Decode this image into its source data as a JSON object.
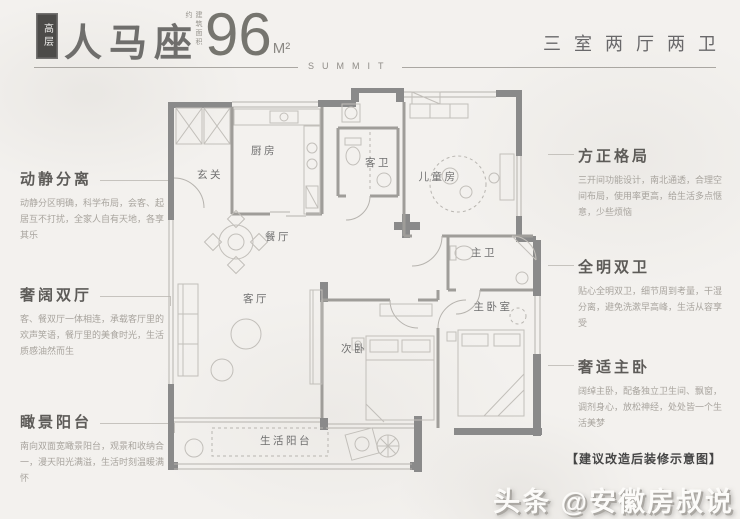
{
  "header": {
    "badge": "高层",
    "title": "人马座",
    "area_prefix": "建筑面积约",
    "area_value": "96",
    "area_unit": "M²",
    "spec": "三室两厅两卫",
    "series": "SUMMIT"
  },
  "features_left": [
    {
      "title": "动静分离",
      "desc": "动静分区明确，科学布局，会客、起居互不打扰，全家人自有天地，各享其乐"
    },
    {
      "title": "奢阔双厅",
      "desc": "客、餐双厅一体相连，承载客厅里的欢声笑语，餐厅里的美食时光，生活质感油然而生"
    },
    {
      "title": "瞰景阳台",
      "desc": "南向双面宽瞰景阳台，观景和收纳合一，漫天阳光满溢，生活时刻温暖满怀"
    }
  ],
  "features_right": [
    {
      "title": "方正格局",
      "desc": "三开间功能设计，南北通透，合理空间布局，使用率更高，给生活多点惬意，少些烦恼"
    },
    {
      "title": "全明双卫",
      "desc": "贴心全明双卫，细节周到考量，干湿分离，避免洗漱早高峰，生活从容享受"
    },
    {
      "title": "奢适主卧",
      "desc": "阔绰主卧，配备独立卫生间、飘窗，调剂身心，放松神经，处处皆一个生活美梦"
    }
  ],
  "floorplan": {
    "rooms": {
      "entry": "玄关",
      "kitchen": "厨房",
      "guest_bath": "客卫",
      "kids_room": "儿童房",
      "dining": "餐厅",
      "living": "客厅",
      "second_bedroom": "次卧",
      "master_bath": "主卫",
      "master_bedroom": "主卧室",
      "balcony": "生活阳台"
    },
    "note": "【建议改造后装修示意图】"
  },
  "watermark": "头条 @安徽房叔说",
  "colors": {
    "background": "#f3f1ee",
    "wall": "#8a8a8a",
    "line": "#b6b3ae",
    "text_dark": "#5d5b58",
    "text_light": "#a8a49e",
    "badge_bg": "#4c4b49"
  }
}
